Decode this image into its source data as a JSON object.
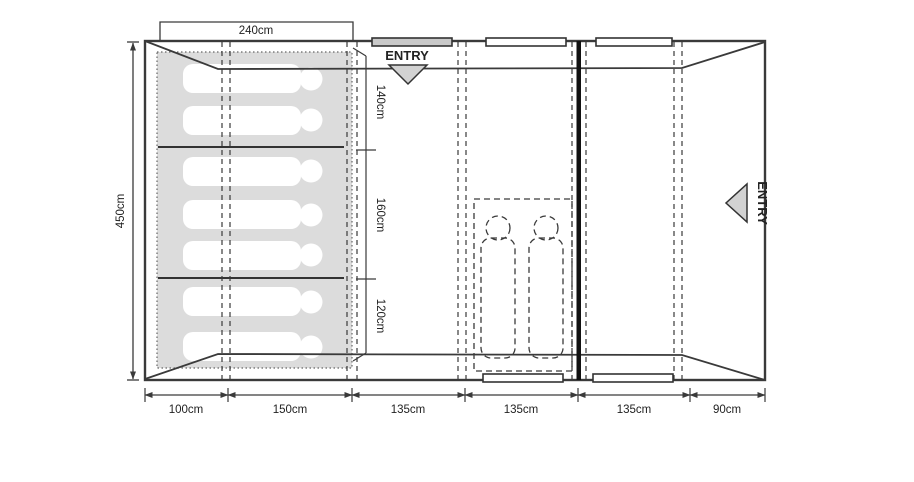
{
  "diagram": {
    "type": "tent-floorplan-top-view",
    "colors": {
      "line": "#3a3a3a",
      "sleep_area_fill": "#dcdcdc",
      "arrow_fill": "#d2d2d2",
      "door_bar_fill": "#c9c9c9",
      "window_bar_fill": "#ffffff",
      "text": "#222222"
    },
    "dimensions": {
      "top_width": "240cm",
      "left_height": "450cm",
      "right_sections": [
        "140cm",
        "160cm",
        "120cm"
      ],
      "bottom_sections": [
        "100cm",
        "150cm",
        "135cm",
        "135cm",
        "135cm",
        "90cm"
      ]
    },
    "labels": {
      "entry_top": "ENTRY",
      "entry_right": "ENTRY"
    },
    "contents": {
      "sleeper_count": 7,
      "sleeping_bag_count": 2,
      "bedroom_sections": 3
    }
  }
}
